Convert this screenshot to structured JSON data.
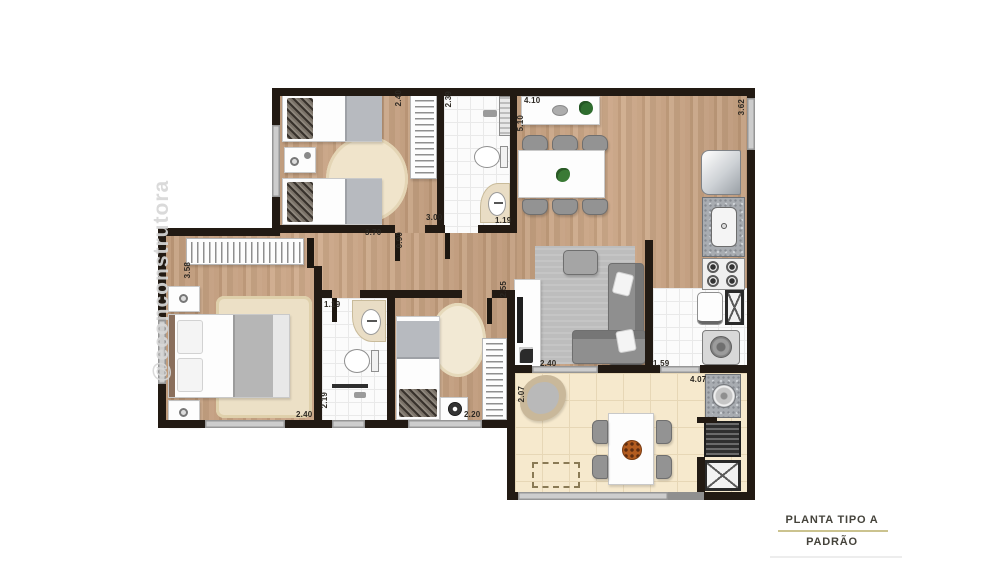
{
  "watermark_text": "@econconstrutora",
  "title_block": {
    "primary": "PLANTA TIPO A",
    "secondary": "PADRÃO"
  },
  "colors": {
    "wall": "#221a13",
    "wood_floor": "#c7a282",
    "terrace_tile": "#f6e9cd",
    "title_rule": "#cbc38f",
    "accent_green": "#2f6d2f",
    "watermark_gray": "#d7d7d7"
  },
  "measurements": {
    "bedroom1_closet_depth": "2.40",
    "bath1_length": "2.39",
    "living_top_width": "4.10",
    "living_height": "5.10",
    "living_right_height": "3.62",
    "bedroom1_width": "3.00",
    "bath1_width": "1.19",
    "hall_width": "3.70",
    "hall_depth": "0.90",
    "master_height": "3.58",
    "bath2_width": "1.19",
    "bath2_height": "2.19",
    "master_width": "2.40",
    "bedroom2_height": "2.55",
    "bedroom2_width": "2.20",
    "living_terrace_opening": "2.40",
    "service_terrace_opening": "1.59",
    "terrace_width": "4.07",
    "terrace_height": "2.07"
  }
}
